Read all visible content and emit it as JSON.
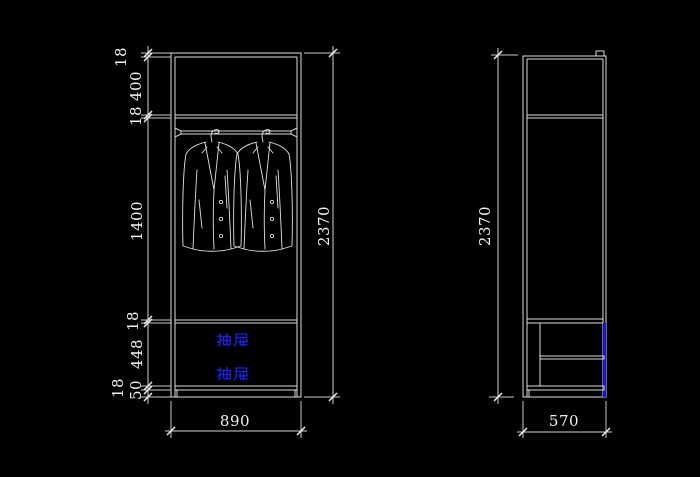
{
  "drawing": {
    "description": "wardrobe CAD elevation drawing, front view and side view",
    "colors": {
      "background": "#000000",
      "line": "#dcdcdc",
      "dimension_text": "#f2f2f2",
      "drawer_highlight": "#1414d8",
      "drawer_label": "#1f1fe8"
    },
    "front_view": {
      "name": "front elevation",
      "vertical_dims": [
        "18",
        "400",
        "18",
        "1400",
        "18",
        "448",
        "18",
        "50"
      ],
      "height_dim": "2370",
      "width_dim": "890",
      "drawer_labels": [
        "抽屉",
        "抽屉"
      ]
    },
    "side_view": {
      "name": "side elevation",
      "height_dim": "2370",
      "depth_dim": "570"
    }
  }
}
